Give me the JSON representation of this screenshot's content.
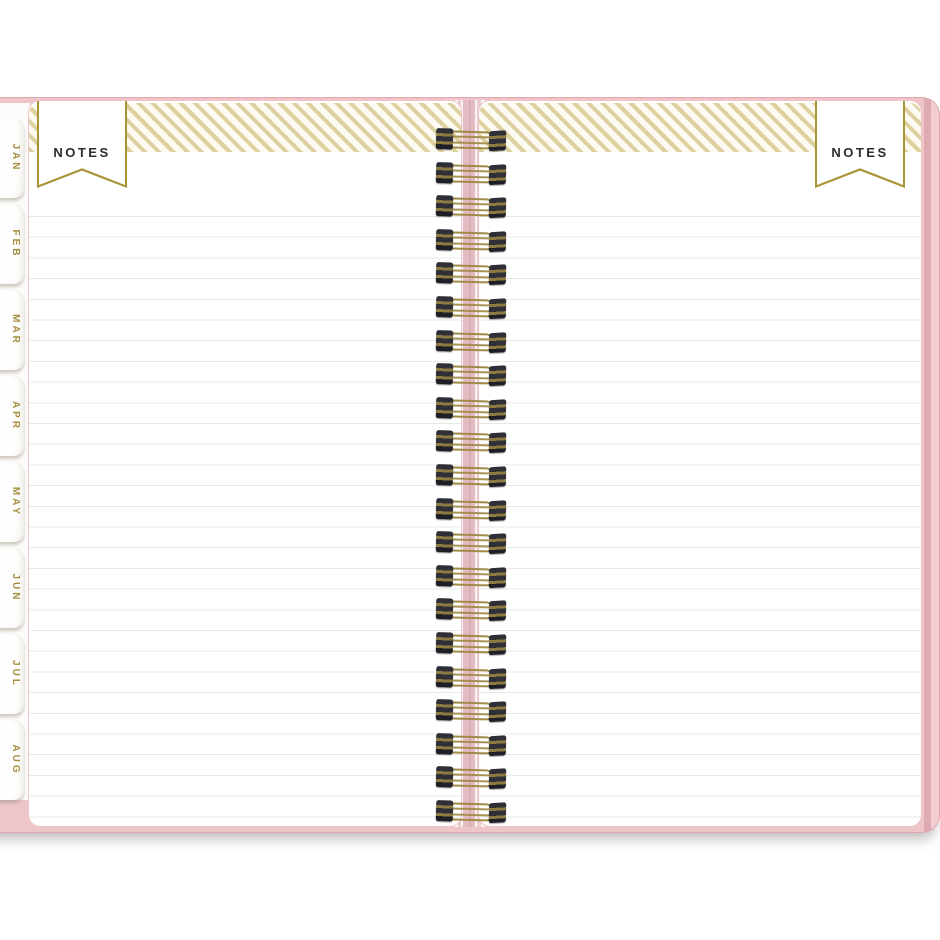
{
  "scene": {
    "description": "Open twin-wire spiral planner notebook photographed on white, showing two blank ruled NOTES pages with gold striped header bands and a pink cover",
    "background_color": "#ffffff"
  },
  "left_page": {
    "banner_label": "NOTES"
  },
  "right_page": {
    "banner_label": "NOTES"
  },
  "month_tabs": {
    "labels": [
      "JAN",
      "FEB",
      "MAR",
      "APR",
      "MAY",
      "JUN",
      "JUL",
      "AUG"
    ]
  },
  "spiral": {
    "coil_count": 21
  },
  "colors": {
    "cover_pink": "#eec6ca",
    "cover_pink_dark": "#dfaab1",
    "page_border_pink": "#f0c3c8",
    "stripe_gold": "#ddd1a0",
    "stripe_bg": "#fcfaf1",
    "banner_border_gold": "#a89435",
    "banner_text": "#2b2b2b",
    "ruled_line": "#e8e8e8",
    "wire_gold": "#a08a48",
    "clip_dark": "#2e2f37",
    "tab_text_gold": "#a59141"
  }
}
